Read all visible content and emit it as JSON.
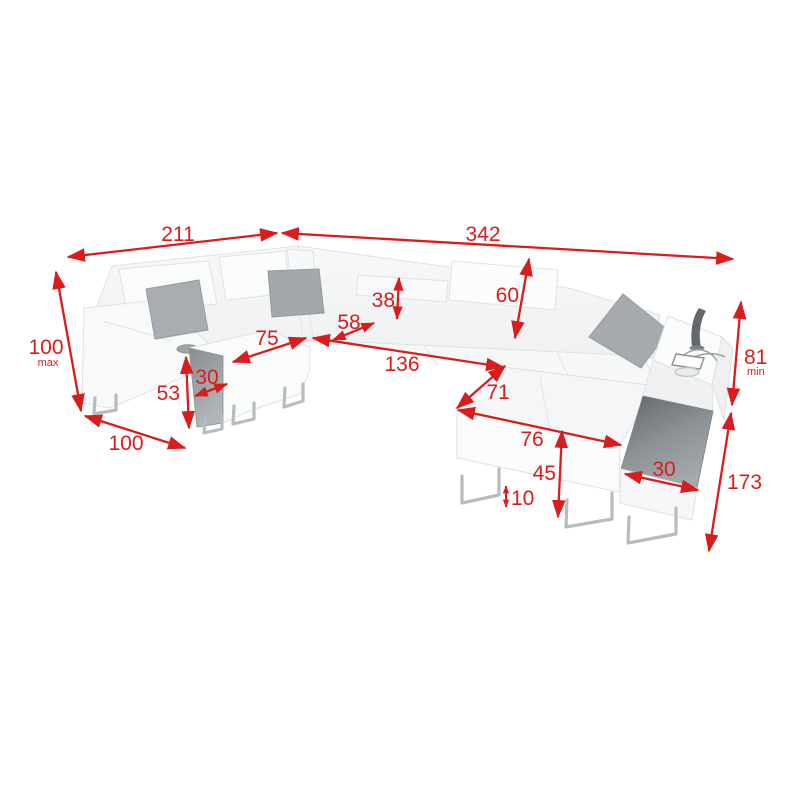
{
  "diagram": {
    "type": "furniture-dimension-diagram",
    "subject": "U-shaped corner sofa with chaise, headrests, shelf armrest with lamp",
    "colors": {
      "accent": "#da1c1c",
      "upholstery": "#f6f7f7",
      "pillow": "#a7acb0",
      "dark_panel": "#8a9094",
      "legs": "#b7bcc0",
      "background": "#ffffff"
    },
    "dimensions": [
      {
        "id": "back-width-left",
        "value": "211"
      },
      {
        "id": "back-width-right",
        "value": "342"
      },
      {
        "id": "height-overall",
        "value": "100",
        "suffix": "max"
      },
      {
        "id": "left-arm-depth",
        "value": "100"
      },
      {
        "id": "ottoman-height",
        "value": "53"
      },
      {
        "id": "ottoman-side-width",
        "value": "30"
      },
      {
        "id": "left-seat-depth",
        "value": "75"
      },
      {
        "id": "corner-seat-width",
        "value": "58"
      },
      {
        "id": "headrest-height",
        "value": "38"
      },
      {
        "id": "backrest-height",
        "value": "60"
      },
      {
        "id": "main-seat-width",
        "value": "136"
      },
      {
        "id": "chaise-seat-width",
        "value": "71"
      },
      {
        "id": "chaise-length",
        "value": "76"
      },
      {
        "id": "chaise-front-height",
        "value": "45"
      },
      {
        "id": "leg-clearance",
        "value": "10"
      },
      {
        "id": "shelf-panel-width",
        "value": "30"
      },
      {
        "id": "height-right",
        "value": "81",
        "suffix": "min"
      },
      {
        "id": "side-depth-total",
        "value": "173"
      }
    ]
  }
}
